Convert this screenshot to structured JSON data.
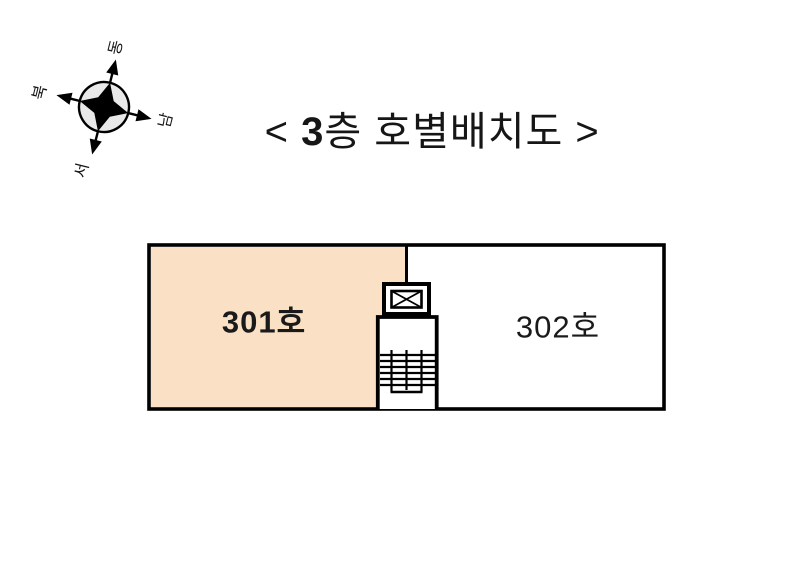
{
  "page": {
    "background_color": "#FFFFFF",
    "wall_color": "#000000"
  },
  "title": {
    "full_text": "< 3층 호별배치도 >",
    "open_bracket": "< ",
    "floor_number": "3",
    "rest": "층 호별배치도 >"
  },
  "compass": {
    "rotation_deg": 14,
    "lobe_color": "#E9E9E9",
    "star_color": "#000000",
    "directions": [
      {
        "id": "east",
        "label": "동",
        "position": "top"
      },
      {
        "id": "north",
        "label": "북",
        "position": "left"
      },
      {
        "id": "south",
        "label": "남",
        "position": "right"
      },
      {
        "id": "west",
        "label": "서",
        "position": "bottom"
      }
    ]
  },
  "floor_plan": {
    "background_fill": "#FFFFFF",
    "rooms": [
      {
        "number": "301호",
        "fill": "#FAE0C4",
        "emphasis": "bold"
      },
      {
        "number": "302호",
        "fill": "#FFFFFF",
        "emphasis": "normal"
      }
    ],
    "core": {
      "elevator_symbol": "crossed-box",
      "stair_tread_count": 6
    }
  }
}
